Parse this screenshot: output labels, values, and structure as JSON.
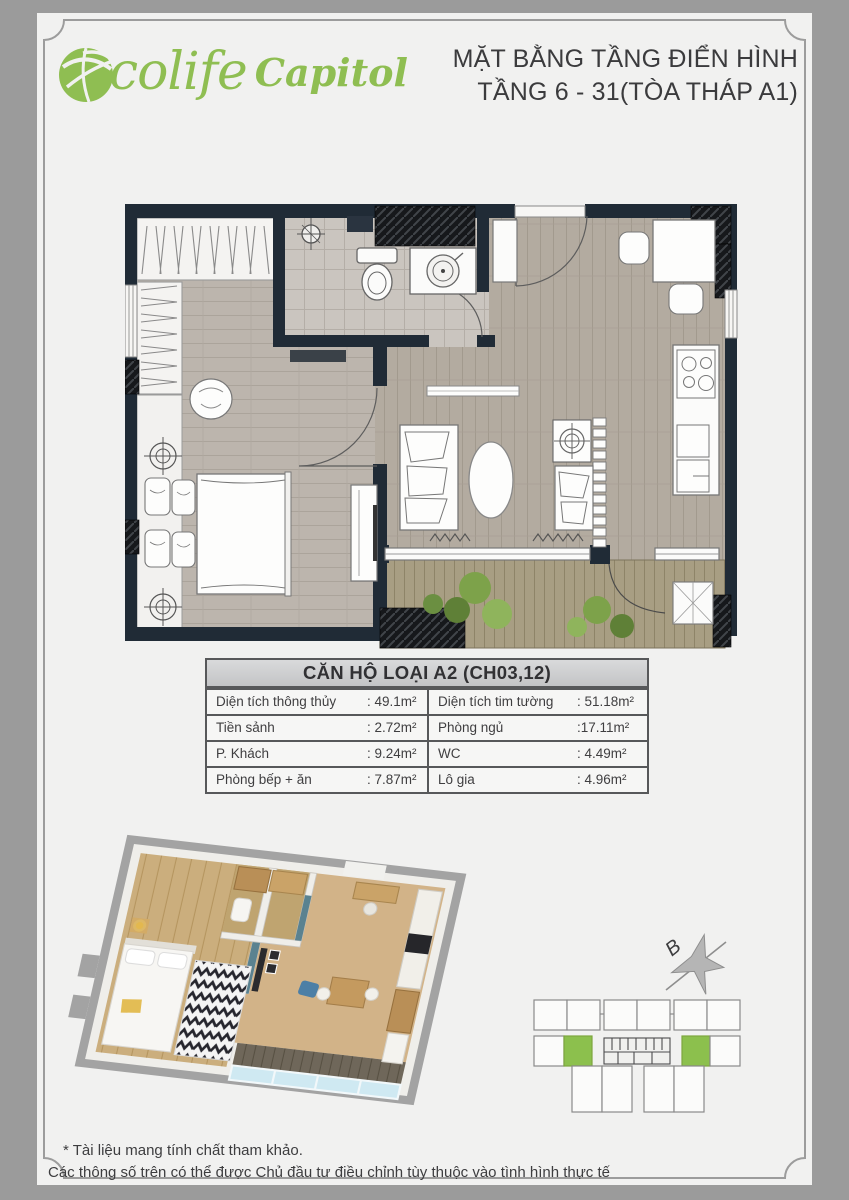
{
  "header": {
    "logo": {
      "part1": "colife",
      "part2": "Capitol"
    },
    "title_line1": "MẶT BẰNG TẦNG ĐIỂN HÌNH",
    "title_line2": "TẦNG 6 - 31(TÒA THÁP A1)"
  },
  "table": {
    "title": "CĂN HỘ LOẠI A2 (CH03,12)",
    "rows": [
      {
        "l1": "Diện tích thông thủy",
        "v1": ": 49.1m²",
        "l2": "Diện tích tim tường",
        "v2": ": 51.18m²"
      },
      {
        "l1": "Tiền sảnh",
        "v1": ": 2.72m²",
        "l2": "Phòng ngủ",
        "v2": ":17.11m²"
      },
      {
        "l1": "P. Khách",
        "v1": ": 9.24m²",
        "l2": "WC",
        "v2": ": 4.49m²"
      },
      {
        "l1": "Phòng bếp + ăn",
        "v1": ": 7.87m²",
        "l2": "Lô gia",
        "v2": ": 4.96m²"
      }
    ]
  },
  "key_plan": {
    "compass_label": "B",
    "highlight_color": "#8cc04d"
  },
  "footer": {
    "line1": "* Tài liệu mang tính chất tham khảo.",
    "line2": "Các thông số trên có thể được Chủ đầu tư điều chỉnh tùy thuộc vào tình hình thực tế"
  },
  "colors": {
    "brand_green": "#8fbe52",
    "wall_dark": "#202b36",
    "unit_green": "#8cc04d"
  }
}
